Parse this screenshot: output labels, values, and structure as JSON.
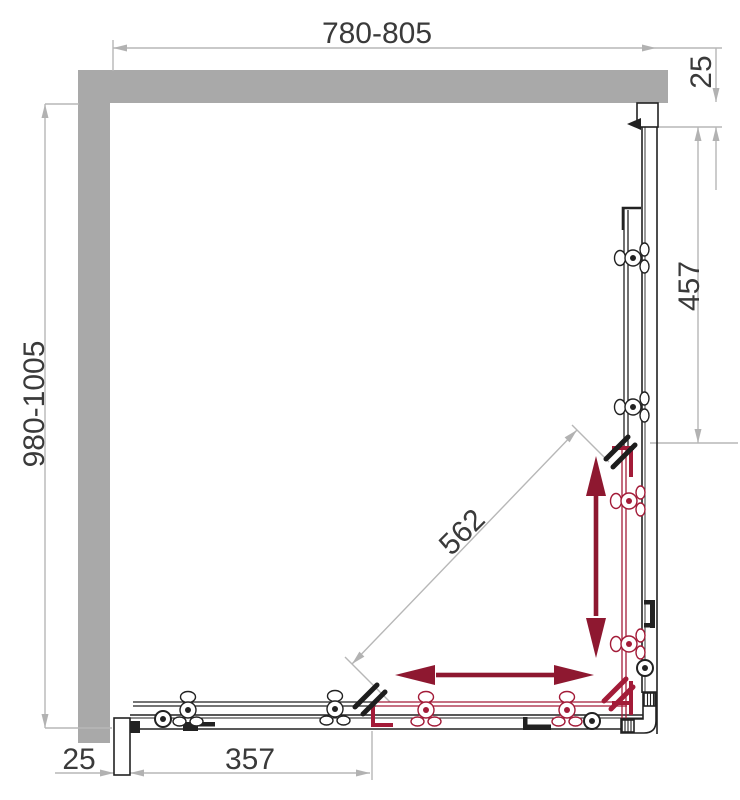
{
  "drawing": {
    "type": "technical-plan",
    "subject": "corner shower enclosure top view with sliding doors",
    "labels": {
      "width_top": "780-805",
      "depth_left": "980-1005",
      "wall_profile_top": "25",
      "fixed_panel_right": "457",
      "entry_diagonal": "562",
      "fixed_panel_bottom": "357",
      "wall_profile_bottom": "25"
    },
    "colors": {
      "wall": "#a9a9a9",
      "dimension_line": "#b7b7b7",
      "dimension_text": "#3a3a3a",
      "frame": "#222222",
      "door_red": "#a31b38",
      "arrow_red": "#8e1830"
    }
  }
}
